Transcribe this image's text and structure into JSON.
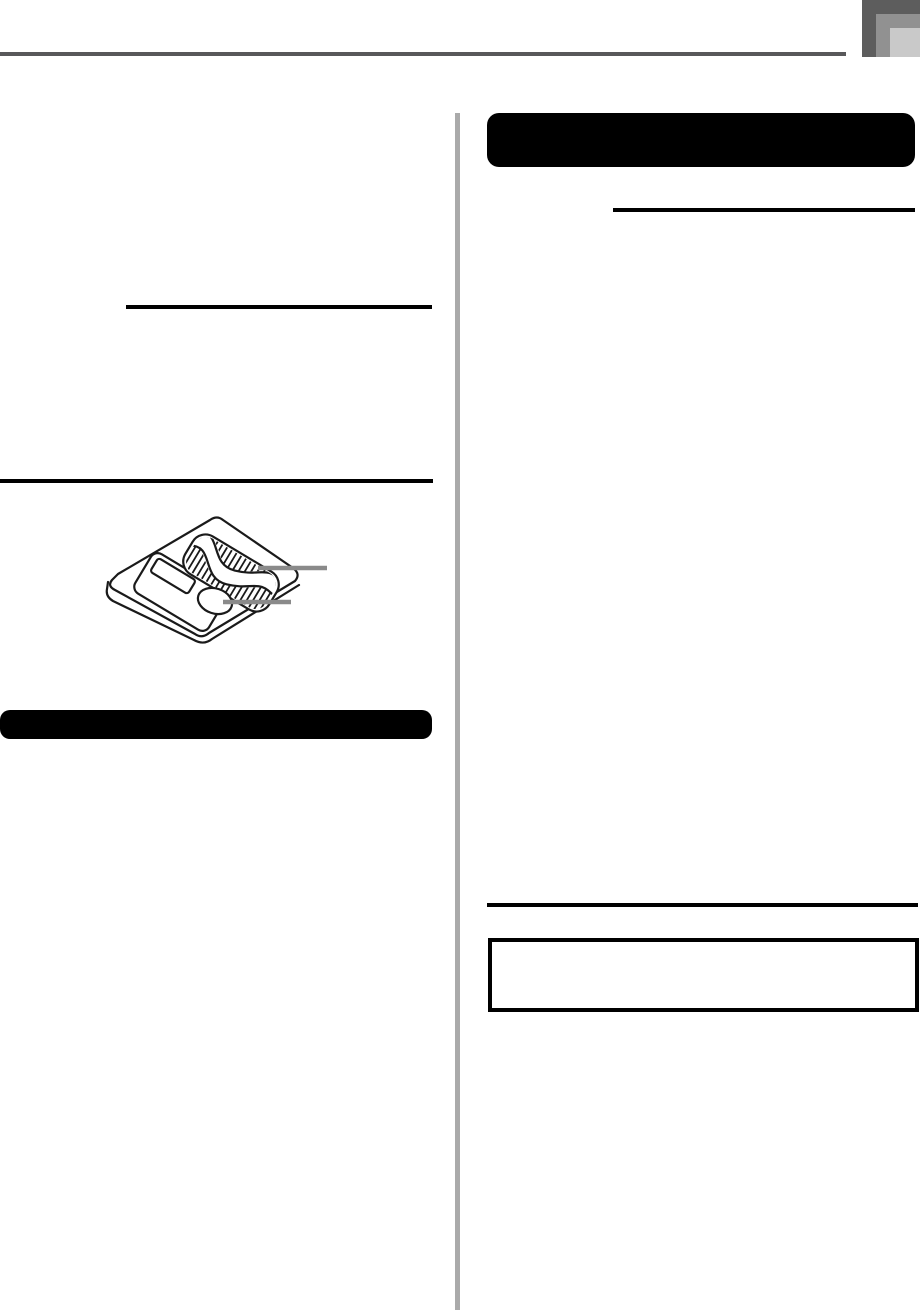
{
  "document": {
    "visible_text": "",
    "columns": 2
  },
  "colors": {
    "page_background": "#ffffff",
    "top_rule": "#58585a",
    "corner_tab_dark": "#5d5d5d",
    "corner_tab_mid": "#919191",
    "corner_tab_light": "#c9c9c9",
    "column_separator": "#aaaaaa",
    "section_bar": "#000000",
    "heading_rule": "#000000",
    "note_box_border": "#000000",
    "callout_line": "#8a8a8a",
    "illustration_line": "#1a1a1a"
  },
  "illustration": {
    "name": "memory-card",
    "callouts": [
      {
        "name": "contact-area"
      },
      {
        "name": "write-protect-area"
      }
    ]
  }
}
